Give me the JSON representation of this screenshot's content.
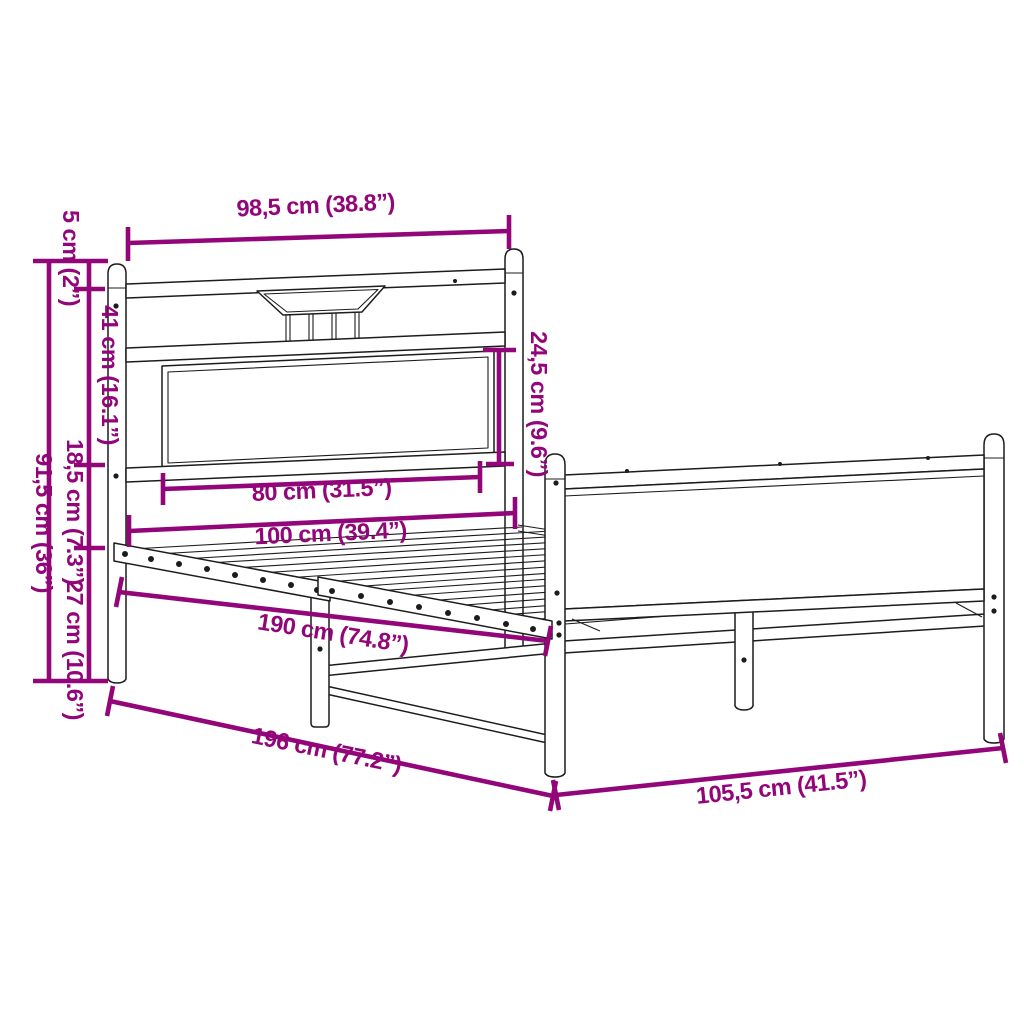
{
  "diagram": {
    "title": "Bed frame dimension diagram",
    "product": "metal bed frame with headboard and footboard",
    "units": "centimeters and inches",
    "background": "#ffffff"
  },
  "colors": {
    "dimension_accent": "#920679",
    "line_art": "#1c1c1c"
  },
  "dims": {
    "headboard_width": "98,5 cm (38.8”)",
    "post_cap_offset": "5 cm (2”)",
    "headboard_upper_height": "41 cm (16.1”)",
    "overall_height": "91,5 cm (36”)",
    "headboard_lower_gap": "18,5 cm (7.3”)",
    "floor_clearance": "27 cm (10.6”)",
    "headboard_panel_height": "24,5 cm (9.6”)",
    "headboard_panel_width": "80 cm (31.5”)",
    "bed_width": "100 cm (39.4”)",
    "bed_length": "190 cm (74.8”)",
    "overall_length": "196 cm (77.2”)",
    "overall_width": "105,5 cm (41.5”)"
  }
}
